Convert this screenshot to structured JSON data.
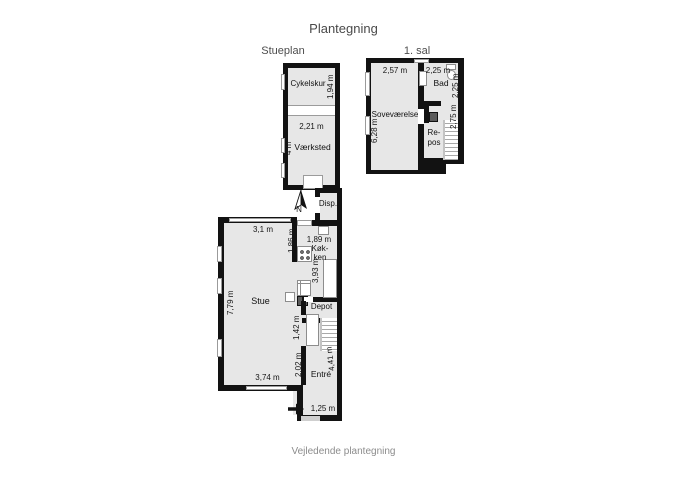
{
  "title": "Plantegning",
  "footer": "Vejledende plantegning",
  "colors": {
    "wall": "#121212",
    "room_fill": "#e7e7e7",
    "chimney": "#5a5a5a",
    "door_gap": "#cfcfcf",
    "background": "#ffffff"
  },
  "stueplan": {
    "label": "Stueplan",
    "north": "N",
    "cykelskur": {
      "name": "Cykelskur",
      "depth": "1,94 m"
    },
    "vaerksted": {
      "name": "Værksted",
      "width": "2,21 m",
      "depth": "4 m"
    },
    "disp": {
      "name": "Disp."
    },
    "koekken": {
      "name1": "Køk-",
      "name2": "ken",
      "width": "1,89 m",
      "depth": "3,93 m",
      "wall": "1,86 m"
    },
    "stue": {
      "name": "Stue",
      "width_top": "3,1 m",
      "depth": "7,79 m",
      "width_bottom": "3,74 m"
    },
    "depot": {
      "name": "Depot"
    },
    "hall": {
      "stair_width": "1,42 m",
      "length": "2,02 m"
    },
    "entre": {
      "name": "Entré",
      "depth": "4,41 m",
      "door_width": "1,25 m"
    }
  },
  "first_floor": {
    "label": "1. sal",
    "sovevaerelse": {
      "name": "Soveværelse",
      "width": "2,57 m",
      "depth": "6,28 m"
    },
    "bad": {
      "name": "Bad",
      "width": "2,25 m",
      "depth": "2,25 m"
    },
    "repos": {
      "name1": "Re-",
      "name2": "pos",
      "depth": "2,75 m"
    }
  }
}
